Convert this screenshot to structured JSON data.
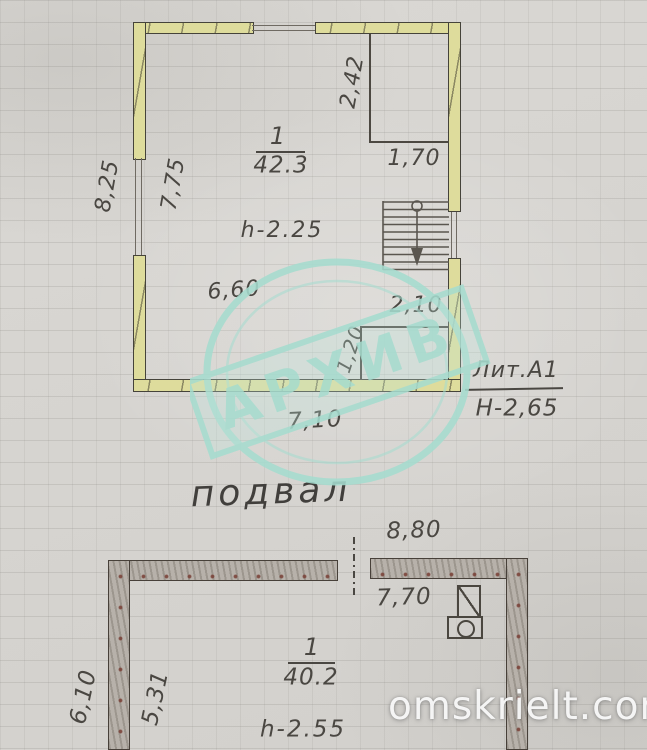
{
  "photo": {
    "stamp_text": "АРХИВ",
    "watermark": "omskrielt.com",
    "caption": "подвал",
    "colors": {
      "paper": "#d6d4d0",
      "timber_wall": "#dedc9c",
      "masonry_wall": "#b7b1aa",
      "ink": "#4a4742",
      "stamp_teal": "#a6dccf",
      "watermark_white": "#fcfcfc"
    }
  },
  "upper_plan": {
    "room": {
      "number": "1",
      "area": "42.3",
      "height": "h-2.25"
    },
    "dims": {
      "left_outer": "8,25",
      "left_inner": "7,75",
      "closet_depth": "2,42",
      "closet_width": "1,70",
      "inner_width": "6,60",
      "niche_width": "2,10",
      "niche_depth": "1,20",
      "bottom_outer": "7,10"
    },
    "litera": {
      "label": "Лит.А1",
      "height": "Н-2,65"
    }
  },
  "lower_plan": {
    "room": {
      "number": "1",
      "area": "40.2",
      "height": "h-2.55"
    },
    "dims": {
      "top_outer": "8,80",
      "top_inner": "7,70",
      "left_outer": "6,10",
      "left_inner": "5,31"
    }
  }
}
